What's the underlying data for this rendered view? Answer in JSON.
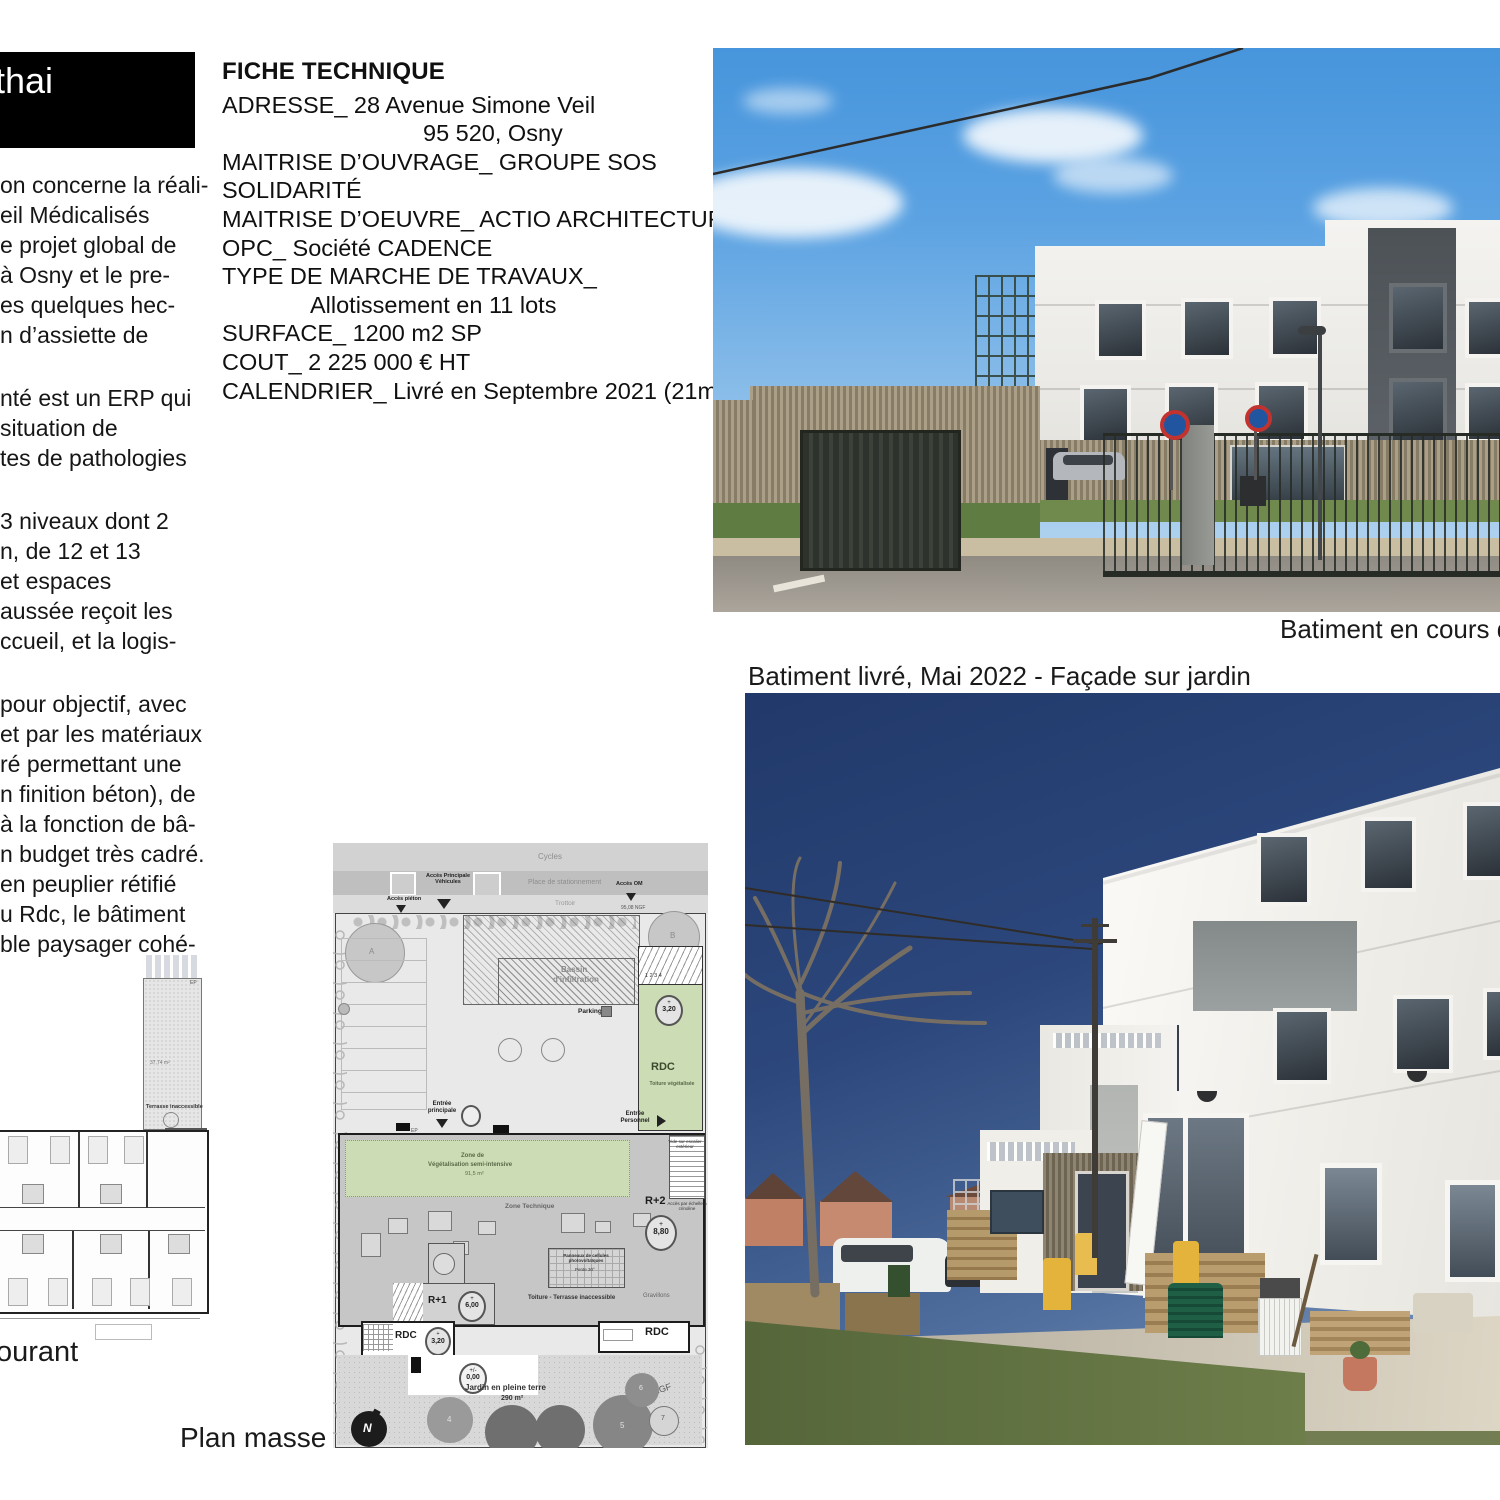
{
  "banner": {
    "title_fragment": "thai"
  },
  "intro": {
    "blocks": [
      {
        "lines": [
          "on concerne la réali-",
          "eil Médicalisés",
          "e projet global de",
          "à Osny et le pre-",
          "es quelques hec-",
          "n d’assiette de"
        ]
      },
      {
        "lines": [
          "nté est un ERP qui",
          "situation de",
          "tes de pathologies"
        ]
      },
      {
        "lines": [
          "3 niveaux dont 2",
          "n, de 12 et 13",
          "et espaces",
          "aussée reçoit les",
          "ccueil, et la logis-"
        ]
      },
      {
        "lines": [
          "pour objectif, avec",
          "et par les matériaux",
          "ré permettant une",
          "n finition béton), de",
          "à la fonction de bâ-",
          "n budget très cadré.",
          "en peuplier rétifié",
          "u Rdc, le bâtiment",
          "ble paysager cohé-"
        ]
      }
    ]
  },
  "fiche": {
    "title": "FICHE TECHNIQUE",
    "rows": [
      {
        "text": "ADRESSE_  28 Avenue Simone Veil"
      },
      {
        "text": "95 520, Osny"
      },
      {
        "text": "MAITRISE D’OUVRAGE_  GROUPE SOS SOLIDARITÉ"
      },
      {
        "text": "MAITRISE D’OEUVRE_  ACTIO ARCHITECTURE"
      },
      {
        "text": "OPC_  Société CADENCE"
      },
      {
        "text": "TYPE DE MARCHE DE TRAVAUX_"
      },
      {
        "text": "Allotissement en 11 lots"
      },
      {
        "text": "SURFACE_   1200 m2 SP"
      },
      {
        "text": "COUT_    2 225 000 € HT"
      },
      {
        "text": "CALENDRIER_  Livré en Septembre 2021 (21mois)"
      }
    ]
  },
  "captions": {
    "construction": "Batiment en cours de",
    "delivered": "Batiment livré, Mai 2022 - Façade sur jardin",
    "floor_plan_fragment": "ourant",
    "site_plan": "Plan masse"
  },
  "floor_plan": {
    "labels": {
      "terrasse": "Terrasse inaccessible",
      "area": "37,74 m²",
      "ep": "EP"
    }
  },
  "site_plan": {
    "labels": {
      "cycles": "Cycles",
      "stationnement": "Place de stationnement",
      "trottoir": "Trottoir",
      "acces_pieton": "Accès piéton",
      "acces_vehicules": "Accès Principale Véhicules",
      "acces_om": "Accès OM",
      "ngf_95": "95,08 NGF",
      "tree_a": "A",
      "tree_b": "B",
      "bassin_1": "Bassin",
      "bassin_2": "d'infiltration",
      "parking": "Parking",
      "rdc": "RDC",
      "toiture_veg": "Toiture végétalisée",
      "plus": "+",
      "level_320": "3,20",
      "stair_nums": "1  2  3  4",
      "entree_principale": "Entrée principale",
      "entree_personnel": "Entrée Personnel",
      "zone_veg_1": "Zone de",
      "zone_veg_2": "Végétalisation semi-intensive",
      "zone_veg_area": "91,5 m²",
      "zone_technique": "Zone Technique",
      "pv_1": "Panneaux de cellules photovoltaïques",
      "pv_2": "Pente 30°",
      "r2": "R+2",
      "level_880": "8,80",
      "r1": "R+1",
      "level_600": "6,00",
      "toiture_terrasse": "Toiture - Terrasse inaccessible",
      "gravillons": "Gravillons",
      "vide_escalier": "Vide sur escalier extérieur",
      "crinoline": "Accès par échelle à crinoline",
      "level_000a": "+/-",
      "level_000b": "0,00",
      "jardin": "Jardin en pleine terre",
      "jardin_area": "290 m²",
      "ngf_94": "94,50 NGF",
      "north": "N",
      "ep": "EP",
      "n4": "4",
      "n5": "5",
      "n6": "6",
      "n7": "7"
    }
  },
  "colors": {
    "banner_bg": "#000000",
    "veg_green": "#ccdcb4",
    "sky_day": "#4795dc",
    "sky_evening": "#21396a"
  }
}
